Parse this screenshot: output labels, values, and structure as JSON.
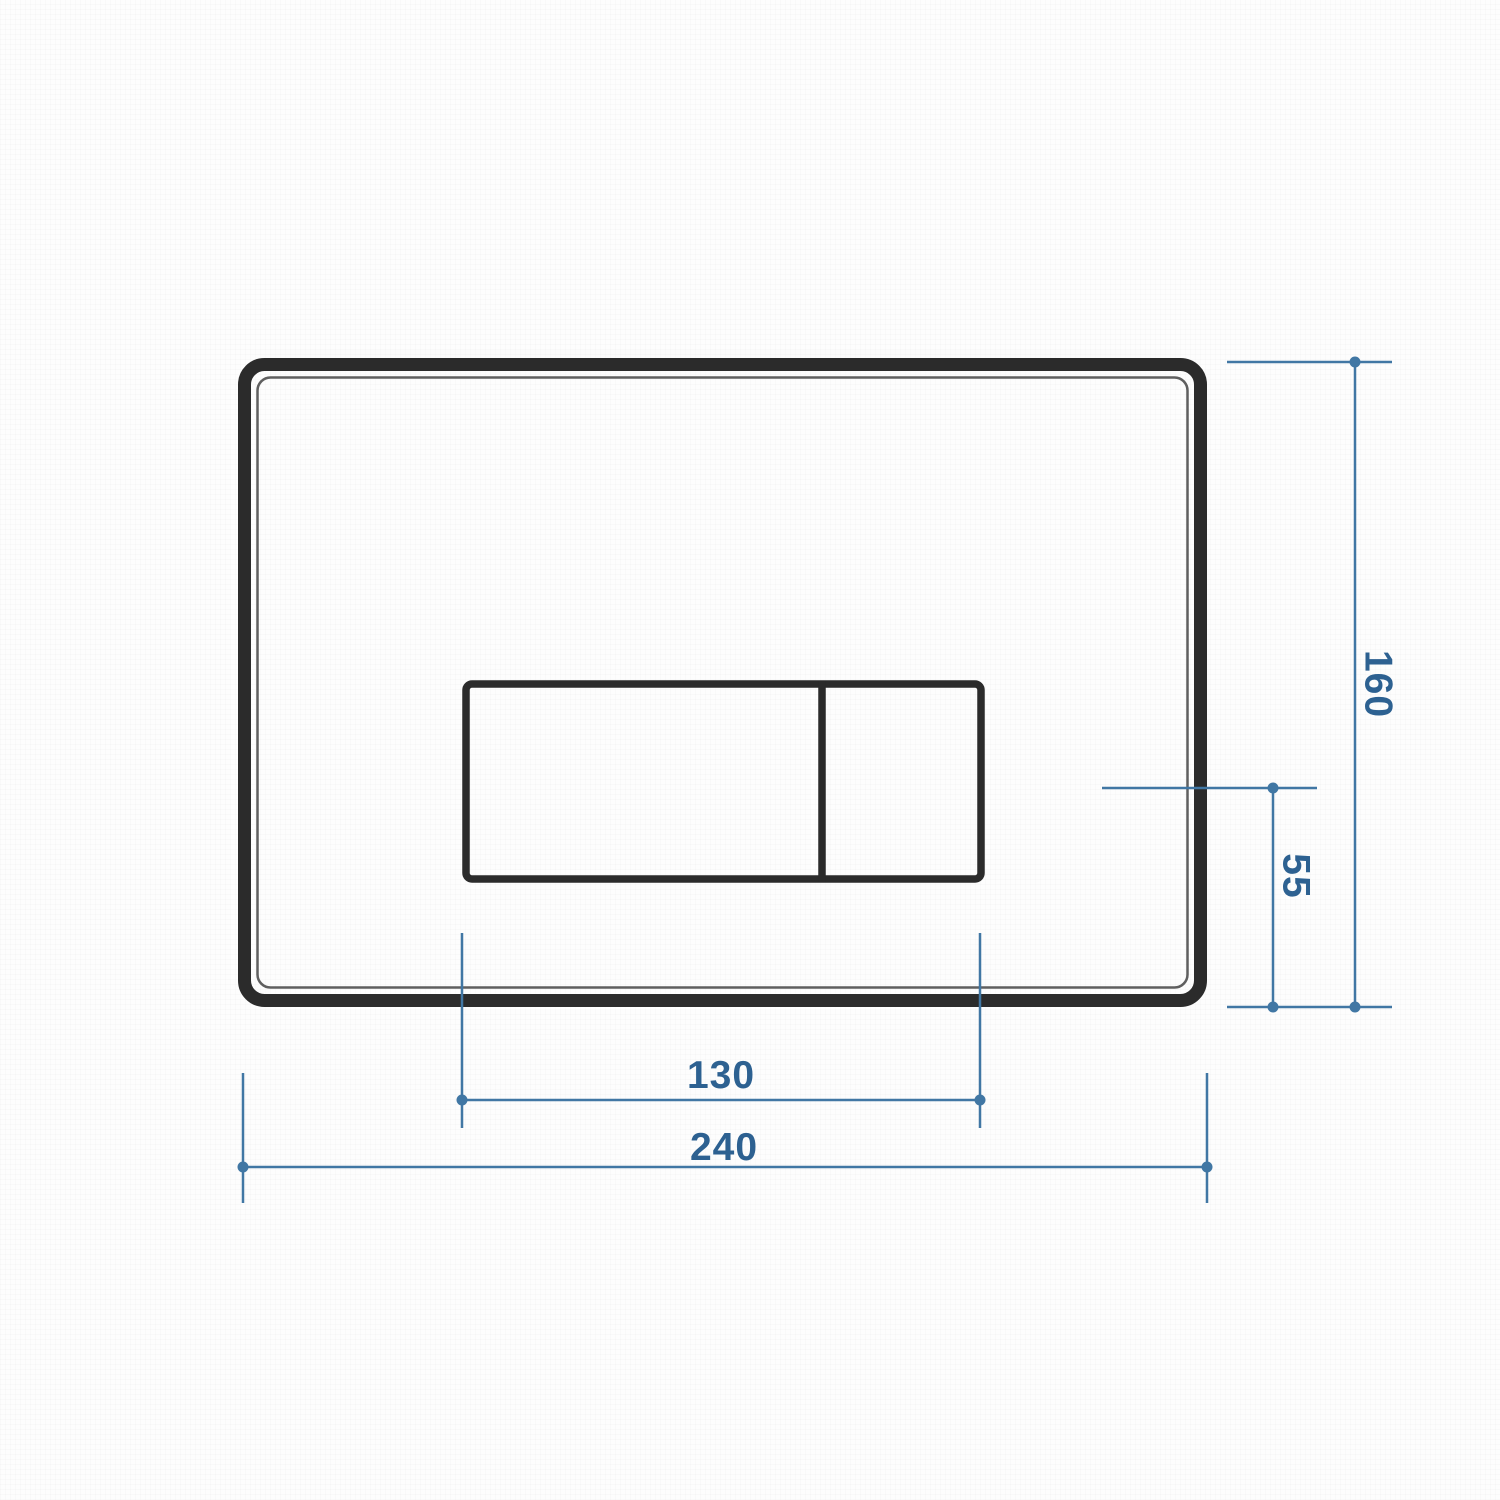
{
  "colors": {
    "dim-line": "#4177a4",
    "dim-text": "#2d6191",
    "plate-stroke": "#2b2b2b",
    "inner-stroke": "#5f5f5f"
  },
  "drawing": {
    "description": "flush-plate-dimension-drawing",
    "dimensions": {
      "plate_width_mm": "240",
      "plate_height_mm": "160",
      "button_group_width_mm": "130",
      "button_centerline_to_bottom_mm": "55"
    }
  }
}
